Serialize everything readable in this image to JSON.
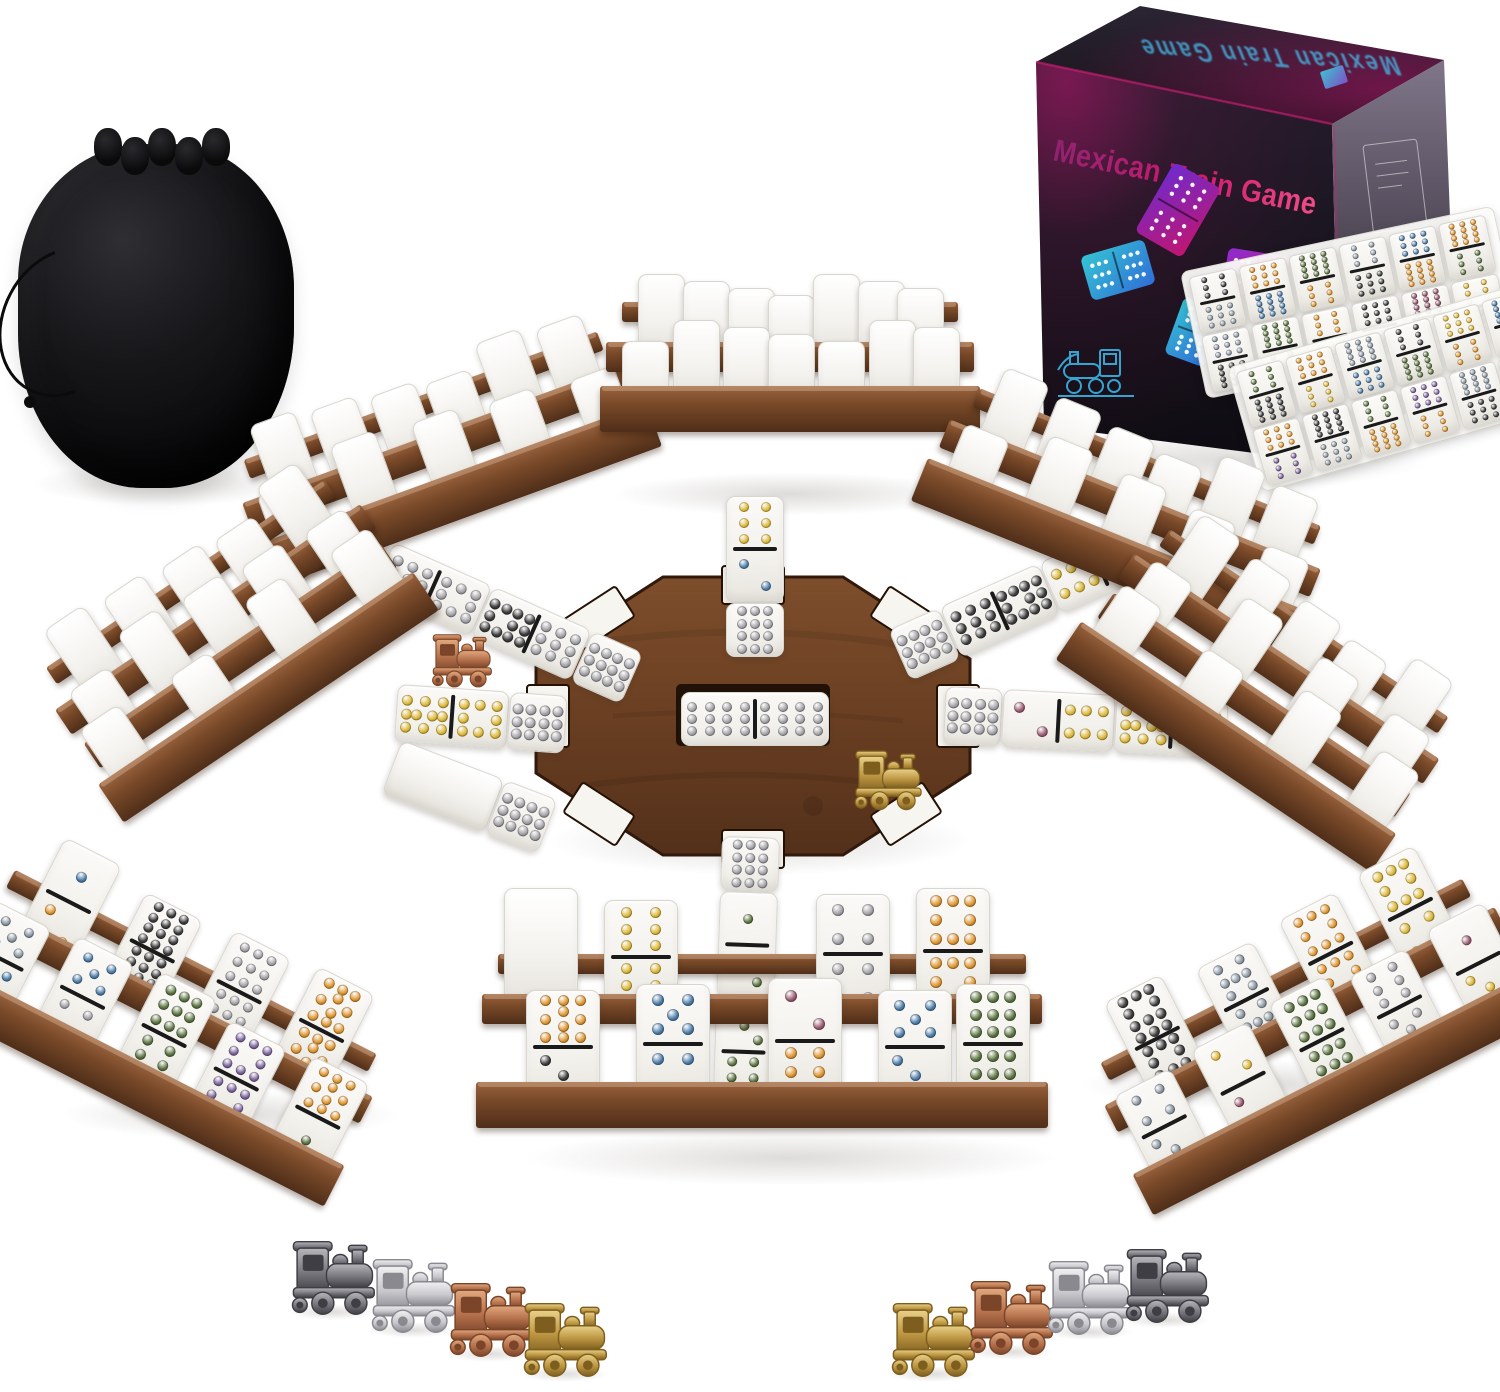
{
  "scene": "mexican-train-dominoes-product-photo",
  "background": "#ffffff",
  "box": {
    "title": "Mexican Train Game",
    "front_bg_top": "#231d2b",
    "front_bg_bottom": "#0e0c12",
    "glow_magenta": "#c01672",
    "title_gradient": [
      "#8f2370",
      "#cf1a6d",
      "#ef4e88"
    ],
    "top_bg": [
      "#2b2433",
      "#151117"
    ],
    "top_text_color": "#45bbe9",
    "side_bg": [
      "#80768a",
      "#4a4350",
      "#2e2936"
    ],
    "edge_highlight": "#d81a77",
    "graphic_teal": [
      "#35c4d4",
      "#2f6ed6"
    ],
    "graphic_magenta": [
      "#8a2bd0",
      "#e0218a"
    ],
    "graphic_purple": [
      "#6d2bd0",
      "#c2156e"
    ],
    "lineart_color": "#3ab5e4",
    "sticker_colors": [
      "#3fd0e0",
      "#7b5bd6"
    ]
  },
  "bag": {
    "body": "#141416",
    "highlight": "#2e2e33",
    "cord": "#0b0b0c"
  },
  "wood": {
    "rail_light": "#9a6440",
    "rail_mid": "#7a4a29",
    "rail_dark": "#4f2e19",
    "hub_light": "#7e4e2c",
    "hub_mid": "#6a3f22",
    "hub_dark": "#53301a",
    "hub_edge": "#31190b",
    "slot": "#f7f5f0",
    "center_slot": "#1d0e04"
  },
  "domino": {
    "face_light": "#fbfaf8",
    "face_dark": "#efede7",
    "edge": "#d9d6cd",
    "divider": "#1a1a1a"
  },
  "pip_colors": {
    "yellow": "#ddb93c",
    "orange": "#df9733",
    "blue": "#4d7ca8",
    "silver": "#a3a3a8",
    "gray": "#8b97a3",
    "black": "#3c3c3c",
    "green": "#5c7442",
    "maroon": "#995b72",
    "purple": "#7c649c"
  },
  "metals": {
    "gunmetal": {
      "light": "#b7b6bb",
      "base": "#77767c",
      "dark": "#3f3e44"
    },
    "silver": {
      "light": "#f0f0f2",
      "base": "#c9c8cd",
      "dark": "#8a8990"
    },
    "copper": {
      "light": "#e2a87e",
      "base": "#b4704b",
      "dark": "#7a4529"
    },
    "gold": {
      "light": "#e9d189",
      "base": "#bb9440",
      "dark": "#7d5e1f"
    }
  },
  "hub": {
    "center_domino": {
      "a": [
        12,
        "silver"
      ],
      "b": [
        12,
        "silver"
      ]
    },
    "tokens": [
      {
        "metal": "gold",
        "location": "southeast-notch"
      },
      {
        "metal": "copper",
        "location": "left-train"
      }
    ]
  },
  "trains": {
    "up": [
      {
        "a": [
          6,
          "yellow"
        ],
        "b": [
          2,
          "blue"
        ]
      },
      {
        "a": [
          12,
          "silver"
        ],
        "half": true
      }
    ],
    "down": [
      {
        "a": [
          12,
          "silver"
        ],
        "half": true
      },
      {
        "a": [
          1,
          "green"
        ],
        "b": [
          2,
          "green"
        ]
      },
      {
        "a": [
          3,
          "green"
        ],
        "b": [
          6,
          "green"
        ]
      }
    ],
    "left": [
      {
        "a": [
          10,
          "yellow"
        ],
        "b": [
          8,
          "yellow"
        ]
      },
      {
        "a": [
          12,
          "silver"
        ],
        "half": true
      }
    ],
    "right": [
      {
        "a": [
          12,
          "silver"
        ],
        "half": true
      },
      {
        "a": [
          2,
          "maroon"
        ],
        "b": [
          6,
          "yellow"
        ]
      },
      {
        "a": [
          10,
          "yellow"
        ],
        "b": [
          6,
          "yellow"
        ]
      }
    ],
    "up_left": [
      {
        "a": [
          9,
          "silver"
        ],
        "b": [
          8,
          "silver"
        ]
      },
      {
        "a": [
          11,
          "black"
        ],
        "b": [
          9,
          "silver"
        ]
      },
      {
        "a": [
          12,
          "silver"
        ],
        "half": true
      }
    ],
    "up_right": [
      {
        "a": [
          12,
          "silver"
        ],
        "half": true
      },
      {
        "a": [
          9,
          "black"
        ],
        "b": [
          11,
          "black"
        ]
      },
      {
        "a": [
          6,
          "yellow"
        ],
        "b": [
          10,
          "yellow"
        ]
      }
    ],
    "down_left": [
      {
        "back": true
      },
      {
        "a": [
          12,
          "silver"
        ],
        "half": true
      }
    ]
  },
  "racks": [
    {
      "id": "top-left",
      "facing": "back",
      "rows": [
        6,
        5
      ]
    },
    {
      "id": "top-center",
      "facing": "back",
      "rows": [
        7,
        7
      ]
    },
    {
      "id": "top-right",
      "facing": "back",
      "rows": [
        6,
        5
      ]
    },
    {
      "id": "left",
      "facing": "back",
      "rows": [
        5,
        5,
        4
      ]
    },
    {
      "id": "right",
      "facing": "back",
      "rows": [
        5,
        4,
        4
      ]
    },
    {
      "id": "bottom-left",
      "facing": "front",
      "rows_front": [
        [
          {
            "a": [
              1,
              "blue"
            ],
            "b": [
              2,
              "orange"
            ]
          },
          {
            "a": [
              12,
              "black"
            ],
            "b": [
              12,
              "black"
            ]
          },
          {
            "a": [
              9,
              "silver"
            ],
            "b": [
              9,
              "silver"
            ]
          },
          {
            "a": [
              10,
              "orange"
            ],
            "b": [
              10,
              "orange"
            ]
          }
        ],
        [
          {
            "a": [
              5,
              "gray"
            ],
            "b": [
              5,
              "blue"
            ]
          },
          {
            "a": [
              5,
              "blue"
            ],
            "b": [
              4,
              "silver"
            ]
          },
          {
            "a": [
              9,
              "green"
            ],
            "b": [
              6,
              "green"
            ]
          },
          {
            "a": [
              8,
              "purple"
            ],
            "b": [
              8,
              "purple"
            ]
          },
          {
            "a": [
              10,
              "orange"
            ],
            "b": [
              1,
              "green"
            ]
          }
        ]
      ]
    },
    {
      "id": "bottom-center",
      "facing": "front",
      "rows_front": [
        [
          {
            "back": true
          },
          {
            "a": [
              6,
              "yellow"
            ],
            "b": [
              6,
              "yellow"
            ]
          },
          {
            "a": [
              4,
              "silver"
            ],
            "b": [
              4,
              "silver"
            ]
          },
          {
            "a": [
              8,
              "orange"
            ],
            "b": [
              8,
              "orange"
            ]
          }
        ],
        [
          {
            "a": [
              10,
              "orange"
            ],
            "b": [
              3,
              "black"
            ]
          },
          {
            "a": [
              5,
              "blue"
            ],
            "b": [
              4,
              "blue"
            ]
          },
          {
            "a": [
              2,
              "maroon"
            ],
            "b": [
              6,
              "orange"
            ]
          },
          {
            "a": [
              5,
              "blue"
            ],
            "b": [
              3,
              "blue"
            ]
          },
          {
            "a": [
              9,
              "green"
            ],
            "b": [
              9,
              "green"
            ]
          }
        ]
      ]
    },
    {
      "id": "bottom-right",
      "facing": "front",
      "rows_front": [
        [
          {
            "a": [
              11,
              "black"
            ],
            "b": [
              11,
              "black"
            ]
          },
          {
            "a": [
              7,
              "gray"
            ],
            "b": [
              7,
              "gray"
            ]
          },
          {
            "a": [
              8,
              "orange"
            ],
            "b": [
              8,
              "orange"
            ]
          },
          {
            "a": [
              8,
              "yellow"
            ],
            "b": [
              4,
              "yellow"
            ]
          }
        ],
        [
          {
            "a": [
              4,
              "gray"
            ],
            "b": [
              3,
              "gray"
            ]
          },
          {
            "a": [
              2,
              "yellow"
            ],
            "b": [
              2,
              "maroon"
            ]
          },
          {
            "a": [
              9,
              "green"
            ],
            "b": [
              9,
              "green"
            ]
          },
          {
            "a": [
              6,
              "silver"
            ],
            "b": [
              5,
              "silver"
            ]
          },
          {
            "a": [
              1,
              "maroon"
            ],
            "b": [
              3,
              "yellow"
            ]
          }
        ]
      ]
    }
  ],
  "tray": {
    "panels": [
      [
        [
          "black",
          "orange",
          "green",
          "gray",
          "blue",
          "orange"
        ],
        [
          "gray",
          "green",
          "orange",
          "black",
          "maroon",
          "yellow"
        ]
      ],
      [
        [
          "green",
          "orange",
          "gray",
          "black",
          "yellow",
          "blue"
        ],
        [
          "orange",
          "black",
          "green",
          "purple",
          "gray",
          "orange"
        ]
      ]
    ]
  },
  "bottom_tokens": {
    "left": [
      "gunmetal",
      "silver",
      "copper",
      "gold"
    ],
    "right": [
      "gold",
      "copper",
      "silver",
      "gunmetal"
    ]
  }
}
